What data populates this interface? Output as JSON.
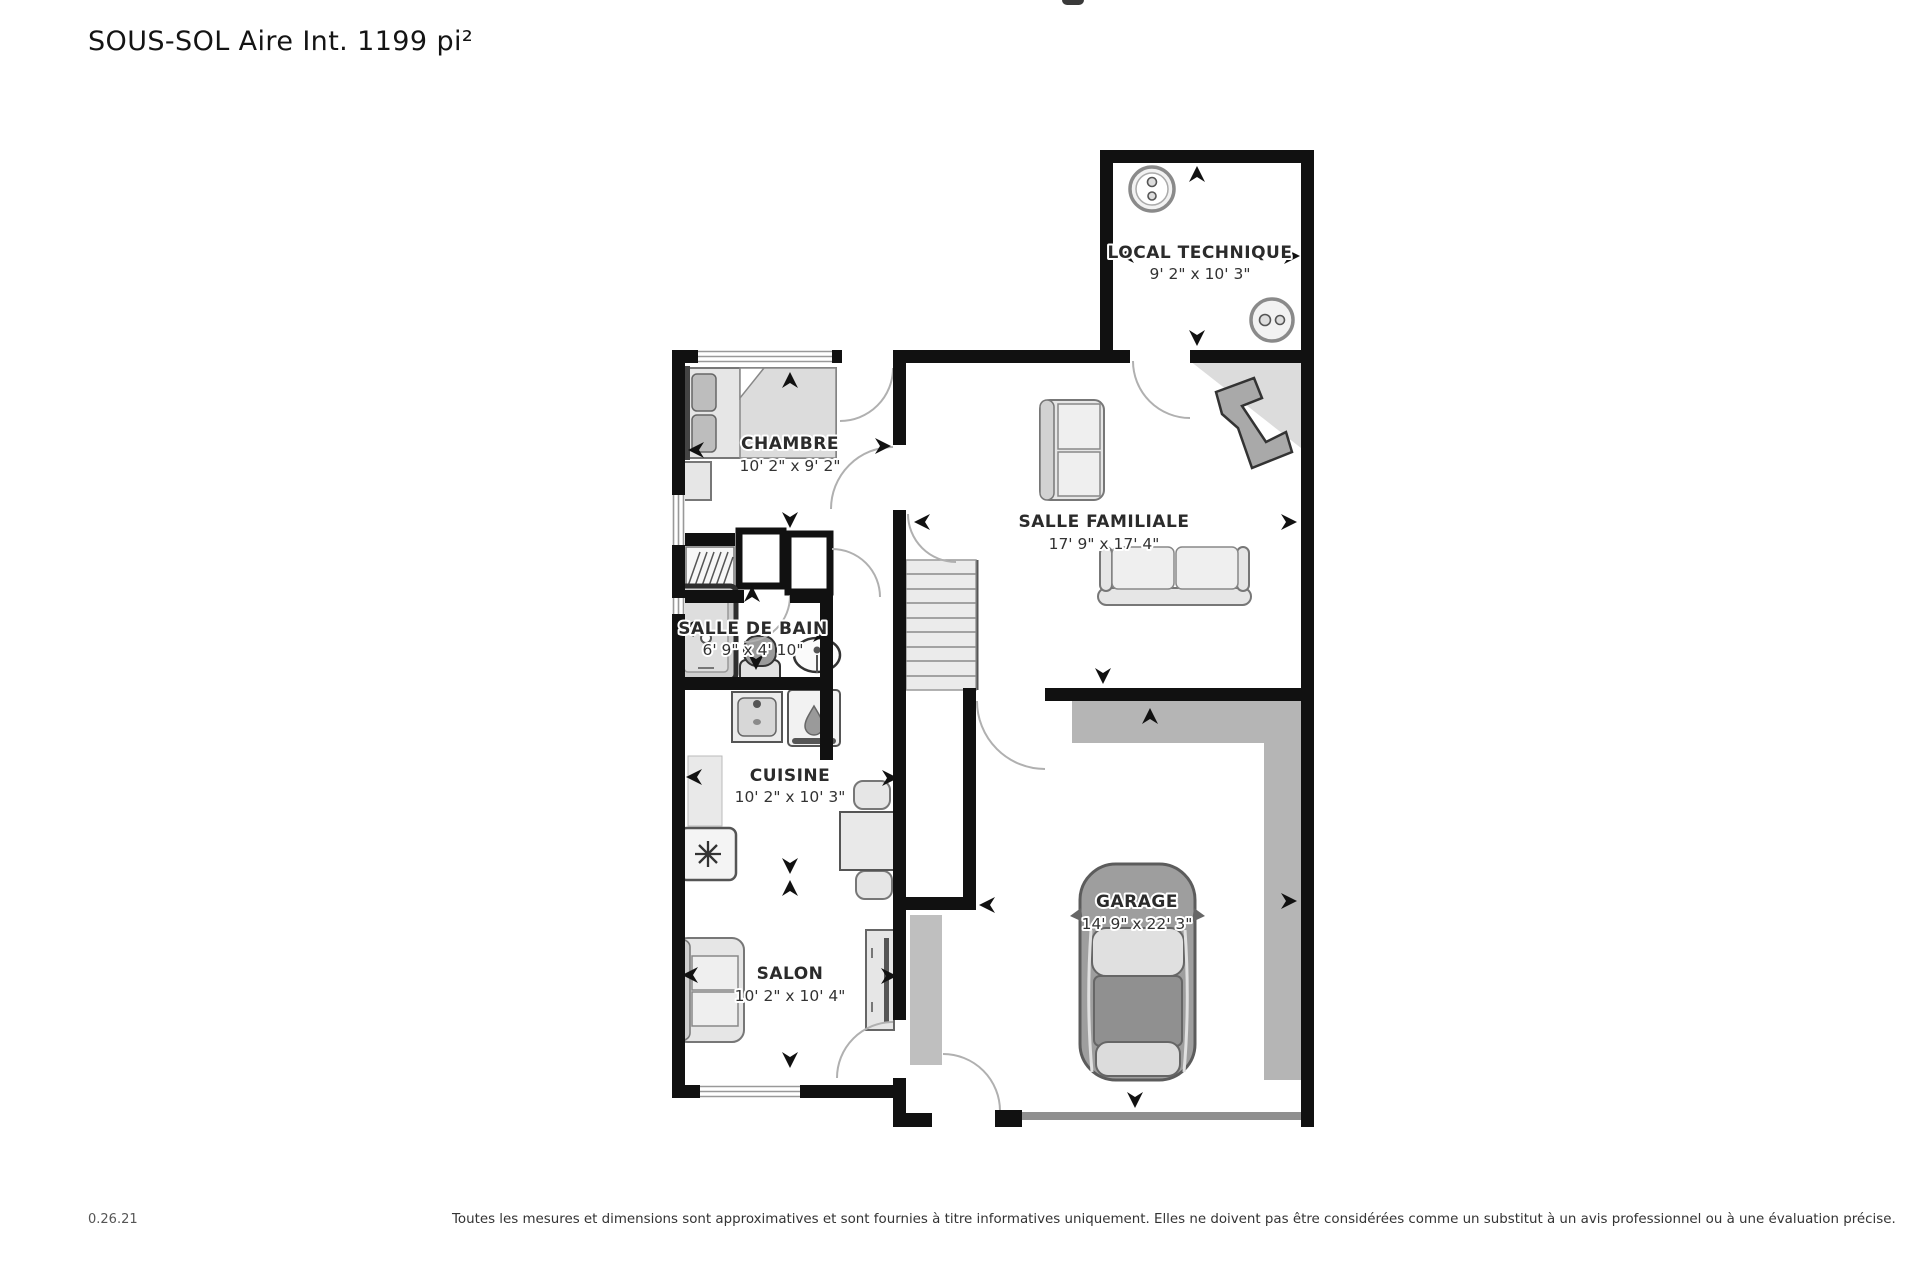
{
  "title": "SOUS-SOL Aire Int. 1199 pi²",
  "floorplan": {
    "rooms": [
      {
        "name": "LOCAL TECHNIQUE",
        "dims": "9' 2\" x 10' 3\""
      },
      {
        "name": "CHAMBRE",
        "dims": "10' 2\" x 9' 2\""
      },
      {
        "name": "SALLE FAMILIALE",
        "dims": "17' 9\" x 17' 4\""
      },
      {
        "name": "SALLE DE BAIN",
        "dims": "6' 9\" x 4' 10\""
      },
      {
        "name": "CUISINE",
        "dims": "10' 2\" x 10' 3\""
      },
      {
        "name": "SALON",
        "dims": "10' 2\" x 10' 4\""
      },
      {
        "name": "GARAGE",
        "dims": "14' 9\" x 22' 3\""
      }
    ],
    "colors": {
      "wall": "#111111",
      "furniture": "#e6e6e6",
      "concrete_band": "#b5b5b5",
      "label_text": "#2b2b2b"
    }
  },
  "footer": {
    "version": "0.26.21",
    "disclaimer": "Toutes les mesures et dimensions sont approximatives et sont fournies à titre informatives uniquement. Elles ne doivent pas être considérées comme un substitut à un avis professionnel ou à une évaluation précise."
  }
}
